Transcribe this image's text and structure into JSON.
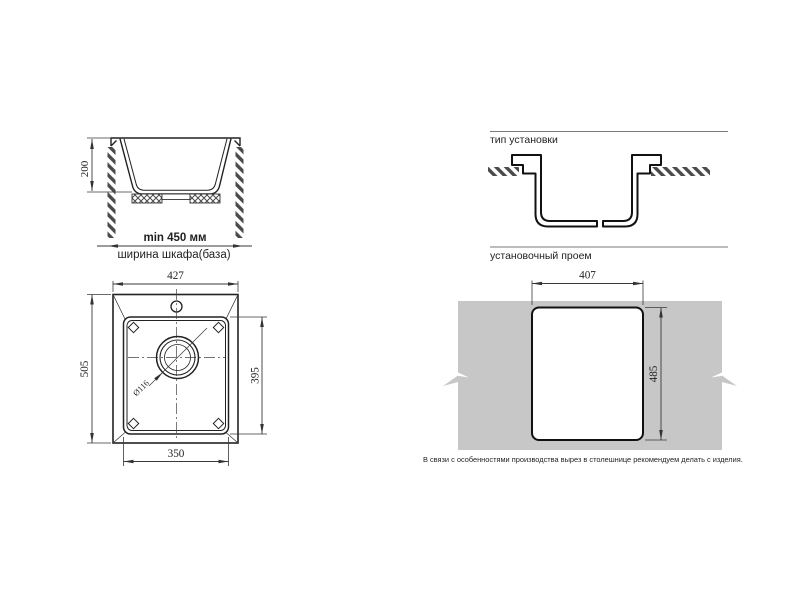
{
  "colors": {
    "line": "#222222",
    "profile": "#111111",
    "dimension": "#3a3a3a",
    "countertop_fill": "#c7c7c7",
    "rule": "#7a7a7a"
  },
  "section_view": {
    "depth": "200",
    "min_width": "min 450 мм",
    "cabinet_width": "ширина шкафа(база)"
  },
  "installation_type": {
    "title": "тип установки"
  },
  "top_view": {
    "overall_width": "427",
    "overall_depth": "505",
    "bowl_depth": "395",
    "bowl_width": "350",
    "drain_diameter": "Ø116"
  },
  "opening": {
    "title": "установочный проем",
    "cutout_width": "407",
    "cutout_height": "485",
    "note": "В связи с особенностями производства вырез в столешнице рекомендуем делать с изделия."
  }
}
